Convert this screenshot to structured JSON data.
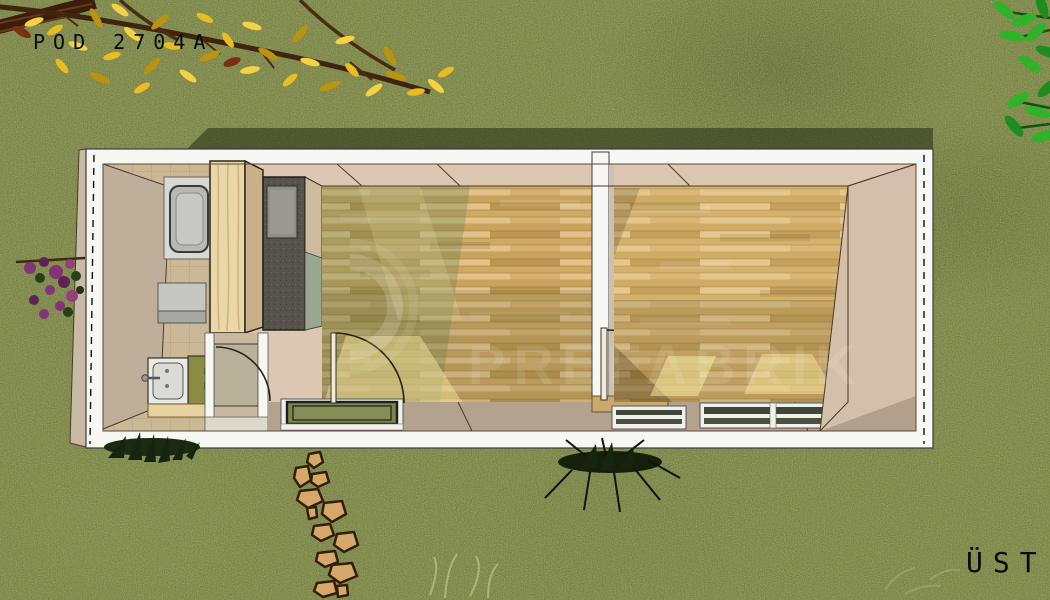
{
  "header": {
    "plan_code": "POD 2704A"
  },
  "footer": {
    "view_label": "ÜST"
  },
  "watermark": {
    "text": "PREFABRIK"
  },
  "palette": {
    "grass": "#76813f",
    "grass_dark": "#5a672f",
    "grass_light": "#98a35c",
    "building_shadow": "rgba(24,32,12,0.48)",
    "wall_white": "#f7f7f3",
    "wall_outline": "#3c3c3c",
    "wall_beige": "#dcc8b2",
    "wall_inner": "#bfae99",
    "wall_bottom": "#b3a28e",
    "tile": "#cbb996",
    "wood": "#d6b172",
    "wood_dark": "#c9a35d",
    "wood_light": "#e2c289",
    "pine": "#e9d6a9",
    "pine_side": "#c9b088",
    "counter": "#55544a",
    "counter_sink": "#8f8f86",
    "fixture_gray": "#b8b9b5",
    "toilet_tank": "#8b8b42",
    "stone": "#d7a76b",
    "stone_outline": "#2f2008",
    "flower_yellow": "#e9bd22",
    "flower_yellow_light": "#f4d246",
    "branch_brown": "#3f2410",
    "leaf_green": "#2fb32b",
    "flower_purple": "#84337a",
    "plant_dark": "#17240f",
    "ink": "#0a0a0a",
    "watermark_white": "rgba(255,255,255,0.11)"
  },
  "scene": {
    "building_rooms": [
      "bathroom",
      "entry",
      "living-room-1",
      "living-room-2"
    ],
    "fixtures": [
      "shower-tray",
      "washbasin",
      "toilet",
      "wardrobe",
      "kitchen-counter"
    ],
    "openings": [
      "entry-door",
      "room1-terrace-door",
      "room2-door",
      "room1-window",
      "room2-window-left",
      "room2-window-right"
    ],
    "landscape": [
      "grass",
      "flowering-branch",
      "green-leaves",
      "purple-shrub",
      "dark-shrub-left",
      "dark-shrub-center",
      "stepping-stones"
    ]
  }
}
